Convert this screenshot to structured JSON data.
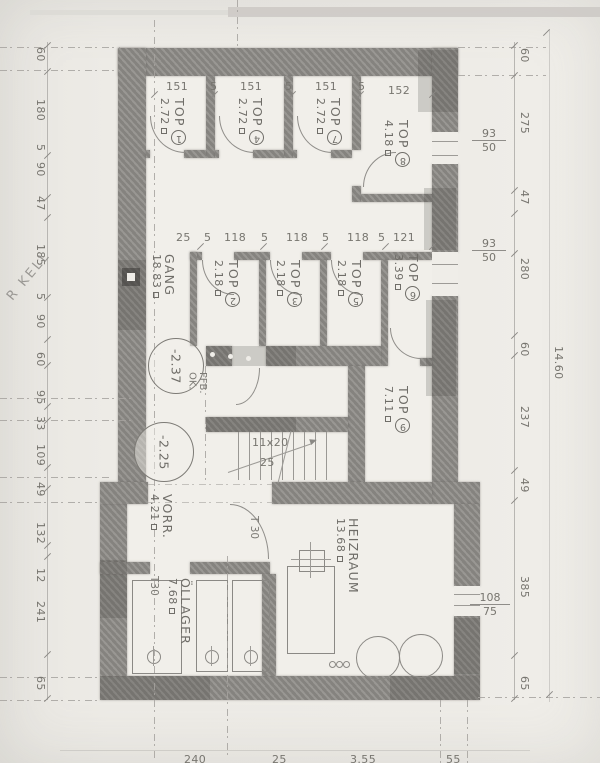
{
  "annotation": "R KELL",
  "rooms": {
    "top1": {
      "name": "TOP",
      "num": "1",
      "area": "2.72"
    },
    "top4": {
      "name": "TOP",
      "num": "4",
      "area": "2.72"
    },
    "top7": {
      "name": "TOP",
      "num": "7",
      "area": "2.72"
    },
    "top8": {
      "name": "TOP",
      "num": "8",
      "area": "4.18"
    },
    "gang": {
      "name": "GANG",
      "area": "18.83"
    },
    "top2": {
      "name": "TOP",
      "num": "2",
      "area": "2.18"
    },
    "top3": {
      "name": "TOP",
      "num": "3",
      "area": "2.18"
    },
    "top5": {
      "name": "TOP",
      "num": "5",
      "area": "2.18"
    },
    "top6": {
      "name": "TOP",
      "num": "6",
      "area": "3.39"
    },
    "top9": {
      "name": "TOP",
      "num": "9",
      "area": "7.11"
    },
    "vorr": {
      "name": "VORR.",
      "area": "4.21"
    },
    "oellager": {
      "name": "ÖLLAGER",
      "area": "7.68"
    },
    "heizraum": {
      "name": "HEIZRAUM",
      "area": "13.68"
    }
  },
  "levels": {
    "upper": {
      "value": "-2.37",
      "note_line1": "OK.",
      "note_line2": "FFB."
    },
    "lower": {
      "value": "-2.25"
    }
  },
  "stairs": {
    "steps": "11x20",
    "width": "25"
  },
  "doors": {
    "d1": "T 30",
    "d2": "T30"
  },
  "dims": {
    "left": [
      "60",
      "180",
      "5",
      "90",
      "47",
      "185",
      "5",
      "90",
      "60",
      "95",
      "33",
      "109",
      "49",
      "132",
      "12",
      "241",
      "65"
    ],
    "right": [
      "60",
      "275",
      "47",
      "280",
      "60",
      "237",
      "49",
      "385",
      "65"
    ],
    "right_total": "14.60",
    "row1": [
      "151",
      "5",
      "151",
      "5",
      "151",
      "5",
      "152"
    ],
    "row2": [
      "25",
      "5",
      "118",
      "5",
      "118",
      "5",
      "118",
      "5",
      "121"
    ],
    "bottom": [
      "240",
      "25",
      "3.55",
      "55"
    ],
    "windows": {
      "w1": {
        "num": "93",
        "den": "50"
      },
      "w2": {
        "num": "93",
        "den": "50"
      },
      "w3": {
        "num": "108",
        "den": "75"
      }
    }
  }
}
